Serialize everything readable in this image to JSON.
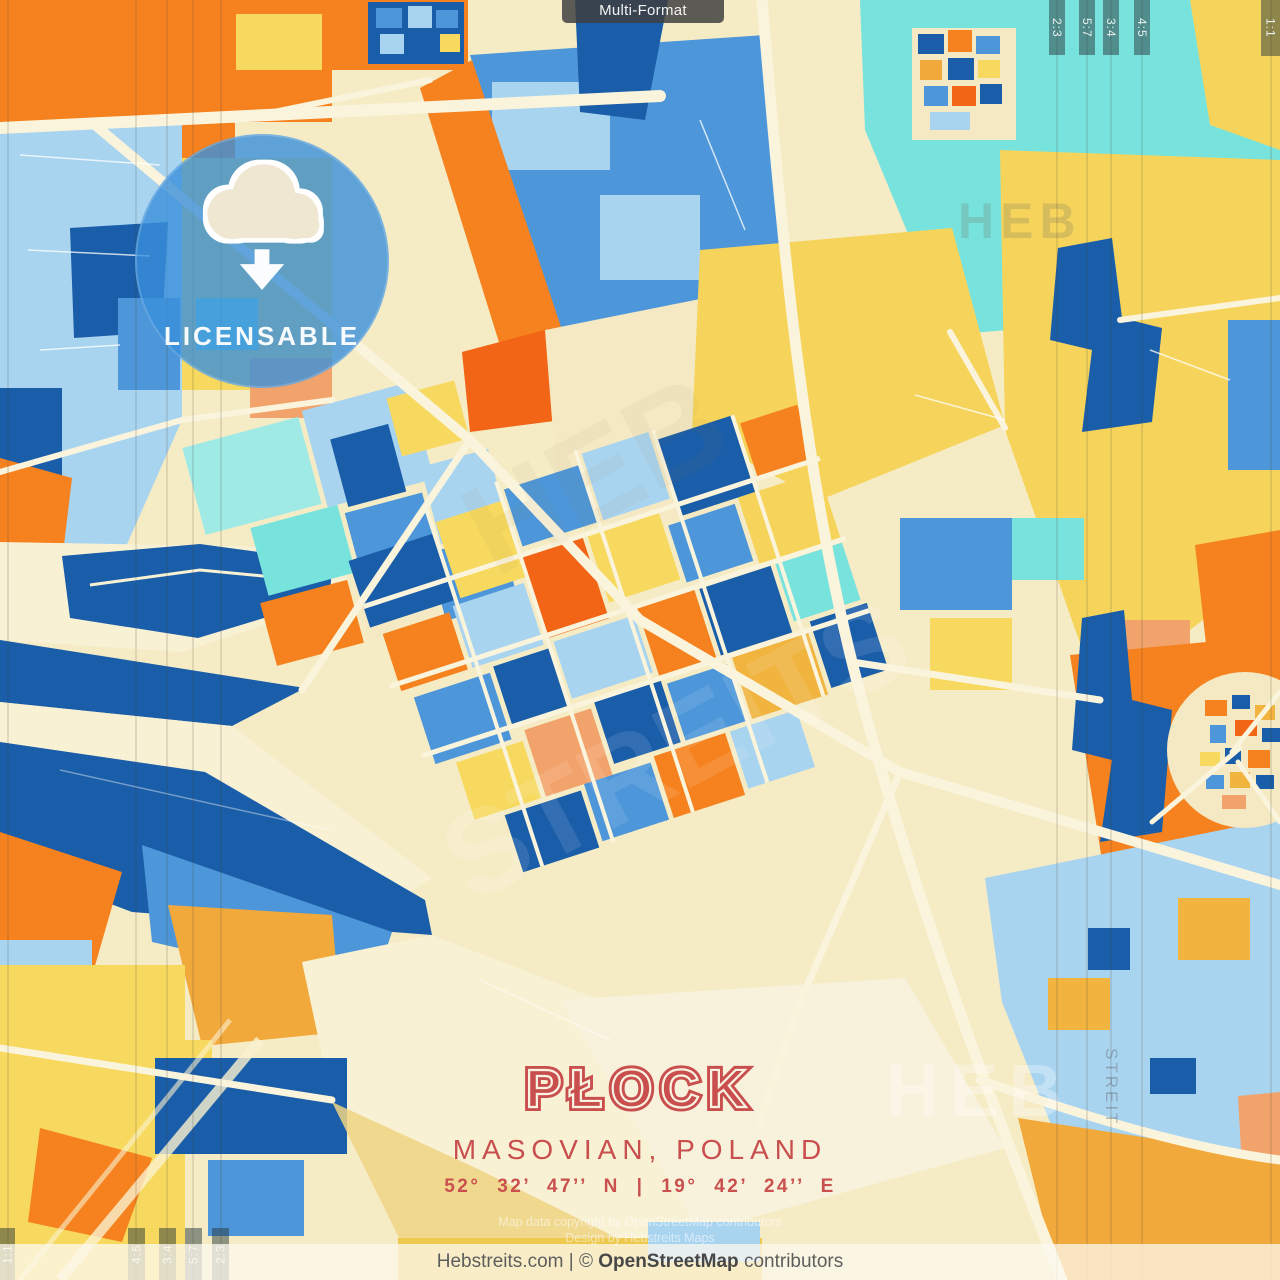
{
  "poster": {
    "width_px": 1280,
    "height_px": 1280,
    "subject": "map poster preview"
  },
  "top_badge": {
    "label": "Multi-Format"
  },
  "license_badge": {
    "label": "LICENSABLE",
    "icon": "cloud-download-icon",
    "circle_color": "#3990DB"
  },
  "aspect_markers": {
    "top_right": [
      "2:3",
      "5:7",
      "3:4",
      "4:5",
      "1:1"
    ],
    "bottom_left": [
      "1:1",
      "4:5",
      "3:4",
      "5:7",
      "2:3"
    ]
  },
  "title_block": {
    "city": "PŁOCK",
    "region": "MASOVIAN, POLAND",
    "coordinates": "52° 32’ 47’’ N | 19° 42’ 24’’ E",
    "accent_color": "#C94E4E"
  },
  "fine_print": {
    "line1": "Map data copyright by OpenStreetMap contributors",
    "line2": "Design by Hebstreits Maps"
  },
  "footer": {
    "prefix": "Hebstreits.com | © ",
    "brand": "OpenStreetMap",
    "suffix": " contributors"
  },
  "watermarks": {
    "brand_top": "HEB",
    "brand_bottom": "HEB",
    "brand_side": "STREIT",
    "brand_diag1": "HEB",
    "brand_diag2": "STREITS"
  },
  "map_palette": {
    "dark_blue": "#1A5DA8",
    "medium_blue": "#4D96D9",
    "light_blue": "#A9D4F0",
    "cyan": "#78E2DD",
    "light_cyan": "#9FEAE5",
    "yellow": "#F7D95F",
    "golden_yellow": "#F6D45C",
    "amber": "#F2A93B",
    "gold_accent": "#F0B43F",
    "orange": "#F5821F",
    "bright_orange": "#F26416",
    "salmon": "#F2A36B",
    "cream_base": "#F5ECC6",
    "pale_river": "#F8F1D4",
    "plains": "#F4E9C3",
    "road": "#FBF4DC"
  }
}
